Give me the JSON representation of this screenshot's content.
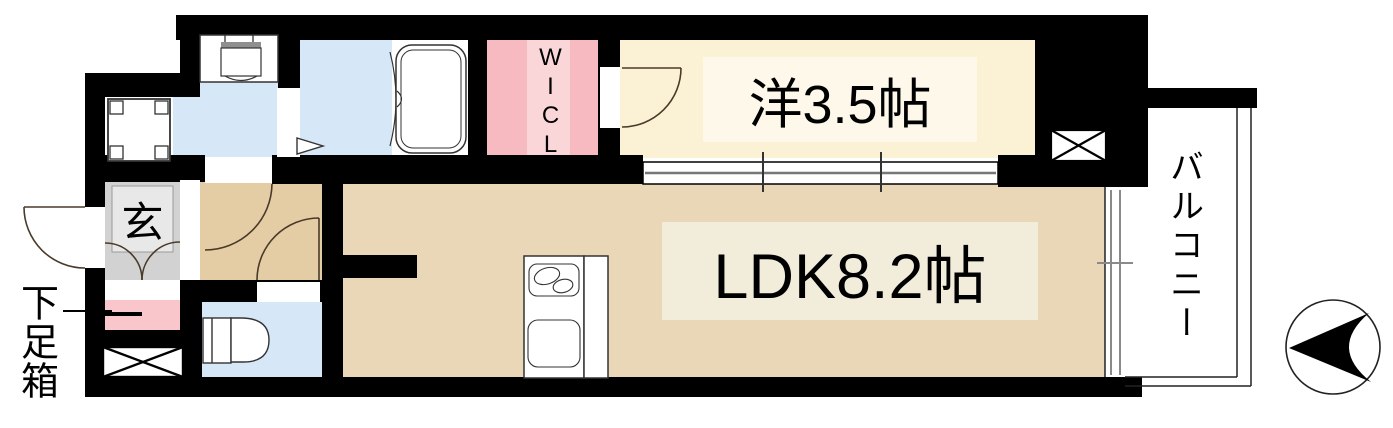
{
  "title": "apartment-floor-plan",
  "labels": {
    "western_room": "洋3.5帖",
    "ldk": "LDK8.2帖",
    "wicl": "WICL",
    "genkan": "玄",
    "shoe_cabinet": "下足箱",
    "balcony": "バルコニー"
  },
  "colors": {
    "wall": "#000000",
    "western_room": "#fbf2d5",
    "western_label_bg": "#fdf8e9",
    "ldk_room": "#e9d7b8",
    "ldk_label_bg": "#f2ecda",
    "hallway": "#e4cca4",
    "wet_room": "#d6e7f7",
    "wicl": "#f7bac0",
    "wicl_stripe": "#fbd6d9",
    "wicl_track": "#9c9c9c",
    "genkan": "#d2d2d2",
    "genkan_step": "#e8e8e8",
    "shoe_cabinet": "#f9c7cb",
    "balcony": "#ffffff"
  }
}
